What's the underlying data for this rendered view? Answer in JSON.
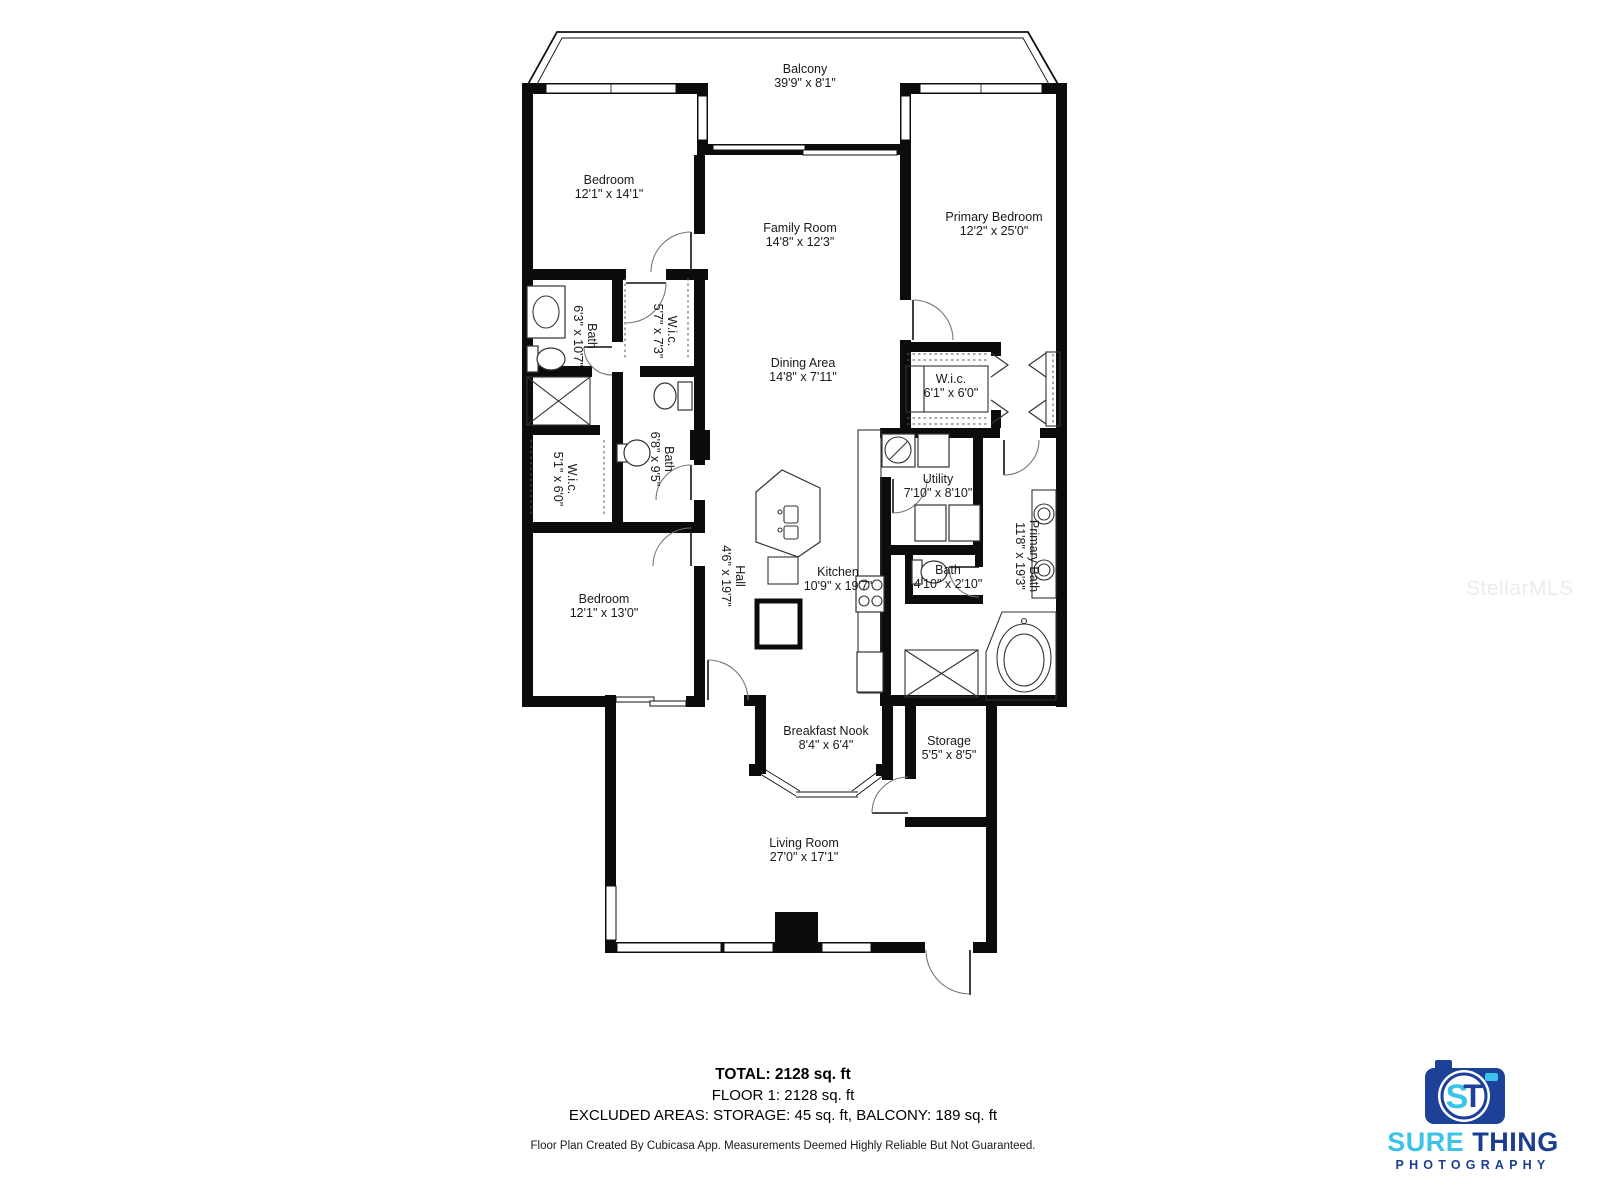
{
  "rooms": [
    {
      "id": "balcony",
      "name": "Balcony",
      "dims": "39'9\" x 8'1\""
    },
    {
      "id": "bedroom-1",
      "name": "Bedroom",
      "dims": "12'1\" x 14'1\""
    },
    {
      "id": "family-room",
      "name": "Family Room",
      "dims": "14'8\" x 12'3\""
    },
    {
      "id": "primary-bedroom",
      "name": "Primary Bedroom",
      "dims": "12'2\" x 25'0\""
    },
    {
      "id": "bath-1",
      "name": "Bath",
      "dims": "6'3\" x 10'7\""
    },
    {
      "id": "wic-1",
      "name": "W.i.c.",
      "dims": "5'7\" x 7'3\""
    },
    {
      "id": "dining-area",
      "name": "Dining Area",
      "dims": "14'8\" x 7'11\""
    },
    {
      "id": "wic-2",
      "name": "W.i.c.",
      "dims": "6'1\" x 6'0\""
    },
    {
      "id": "wic-3",
      "name": "W.i.c.",
      "dims": "5'1\" x 6'0\""
    },
    {
      "id": "bath-2",
      "name": "Bath",
      "dims": "6'8\" x 9'5\""
    },
    {
      "id": "utility",
      "name": "Utility",
      "dims": "7'10\" x 8'10\""
    },
    {
      "id": "hall",
      "name": "Hall",
      "dims": "4'6\" x 19'7\""
    },
    {
      "id": "kitchen",
      "name": "Kitchen",
      "dims": "10'9\" x 19'7\""
    },
    {
      "id": "bath-3",
      "name": "Bath",
      "dims": "4'10\" x 2'10\""
    },
    {
      "id": "primary-bath",
      "name": "Primary Bath",
      "dims": "11'8\" x 19'3\""
    },
    {
      "id": "bedroom-2",
      "name": "Bedroom",
      "dims": "12'1\" x 13'0\""
    },
    {
      "id": "breakfast-nook",
      "name": "Breakfast Nook",
      "dims": "8'4\" x 6'4\""
    },
    {
      "id": "storage",
      "name": "Storage",
      "dims": "5'5\" x 8'5\""
    },
    {
      "id": "living-room",
      "name": "Living Room",
      "dims": "27'0\" x 17'1\""
    }
  ],
  "summary": {
    "total": "TOTAL: 2128 sq. ft",
    "floor": "FLOOR 1: 2128 sq. ft",
    "excluded": "EXCLUDED AREAS: STORAGE: 45 sq. ft, BALCONY: 189 sq. ft",
    "disclaimer": "Floor Plan Created By Cubicasa App. Measurements Deemed Highly Reliable But Not Guaranteed."
  },
  "logo": {
    "word1": "SURE",
    "word2": "THING",
    "line2": "PHOTOGRAPHY",
    "monogram_s": "S",
    "monogram_t": "T",
    "colors": {
      "cyan": "#3CC3E8",
      "blue": "#1B3E8F",
      "body": "#1D4199"
    }
  },
  "watermark": "StellarMLS",
  "colors": {
    "wall": "#0c0c0c",
    "label": "#1a1a1a",
    "background": "#ffffff"
  }
}
